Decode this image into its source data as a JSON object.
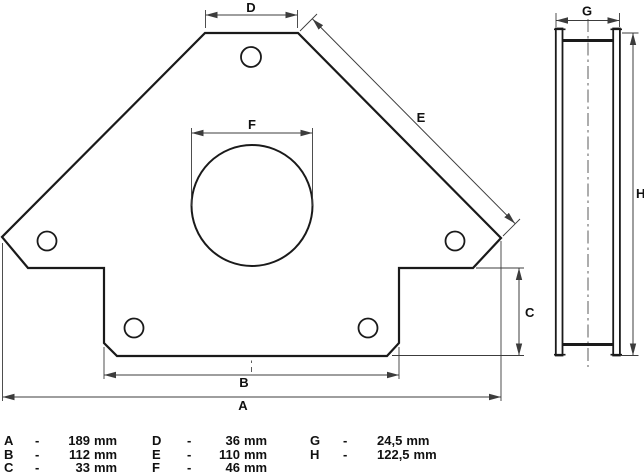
{
  "front_view": {
    "labels": {
      "A": "A",
      "B": "B",
      "C": "C",
      "D": "D",
      "E": "E",
      "F": "F"
    }
  },
  "side_view": {
    "labels": {
      "G": "G",
      "H": "H"
    }
  },
  "legend": {
    "entries": [
      {
        "key": "A",
        "sep": "-",
        "value": "189",
        "unit": "mm"
      },
      {
        "key": "B",
        "sep": "-",
        "value": "112",
        "unit": "mm"
      },
      {
        "key": "C",
        "sep": "-",
        "value": "33",
        "unit": "mm"
      },
      {
        "key": "D",
        "sep": "-",
        "value": "36",
        "unit": "mm"
      },
      {
        "key": "E",
        "sep": "-",
        "value": "110",
        "unit": "mm"
      },
      {
        "key": "F",
        "sep": "-",
        "value": "46",
        "unit": "mm"
      },
      {
        "key": "G",
        "sep": "-",
        "value": "24,5",
        "unit": "mm"
      },
      {
        "key": "H",
        "sep": "-",
        "value": "122,5",
        "unit": "mm"
      }
    ]
  },
  "colors": {
    "line": "#1a1a1a",
    "thin": "#3c3c3c",
    "bg": "#ffffff"
  }
}
